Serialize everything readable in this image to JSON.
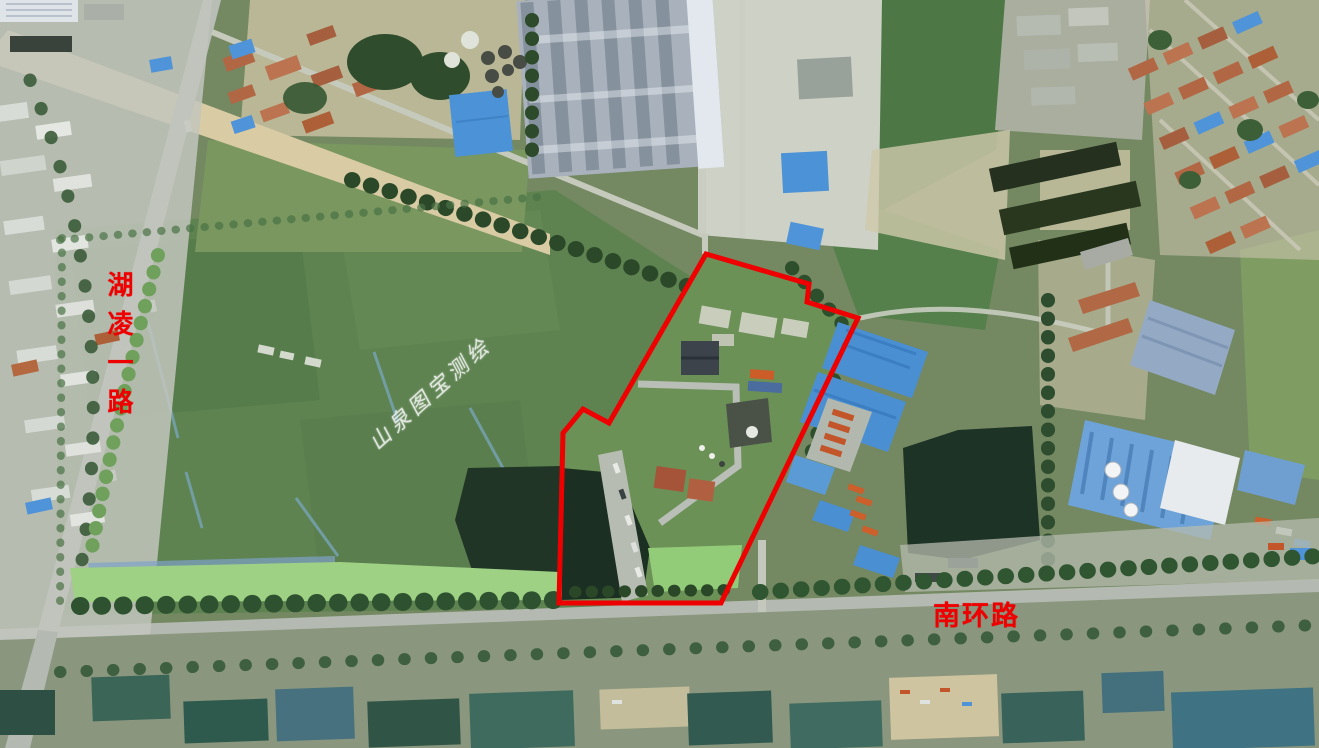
{
  "scene": {
    "type": "satellite aerial imagery with land-parcel annotation",
    "width_px": 1319,
    "height_px": 748
  },
  "annotations": {
    "vertical_road_label": {
      "text": "湖凌一路",
      "color": "#ef0000",
      "orientation": "vertical"
    },
    "horizontal_road_label": {
      "text": "南环路",
      "color": "#ef0000",
      "orientation": "horizontal"
    },
    "watermark": {
      "text": "山泉图宝测绘",
      "color": "#ffffff",
      "rotation_deg": -42
    },
    "parcel_outline": {
      "color": "#ef0000",
      "stroke_width": 5,
      "points": "706,254 809,284 807,302 858,318 721,603 559,603 563,433 583,409 609,423"
    }
  },
  "palette": {
    "field_green": "#5e8351",
    "grass_light": "#93cc78",
    "tree_dark": "#2b4929",
    "road_gray": "#b4bab2",
    "dirt_tan": "#d9cba4",
    "blue_roof": "#4b92d6",
    "teal_roof": "#3f6b60",
    "terracotta_roof": "#b26744",
    "factory_roof_gray": "#86919e",
    "pond_dark": "#1d3326",
    "annotation_red": "#ef0000",
    "watermark_white": "#ffffff"
  }
}
